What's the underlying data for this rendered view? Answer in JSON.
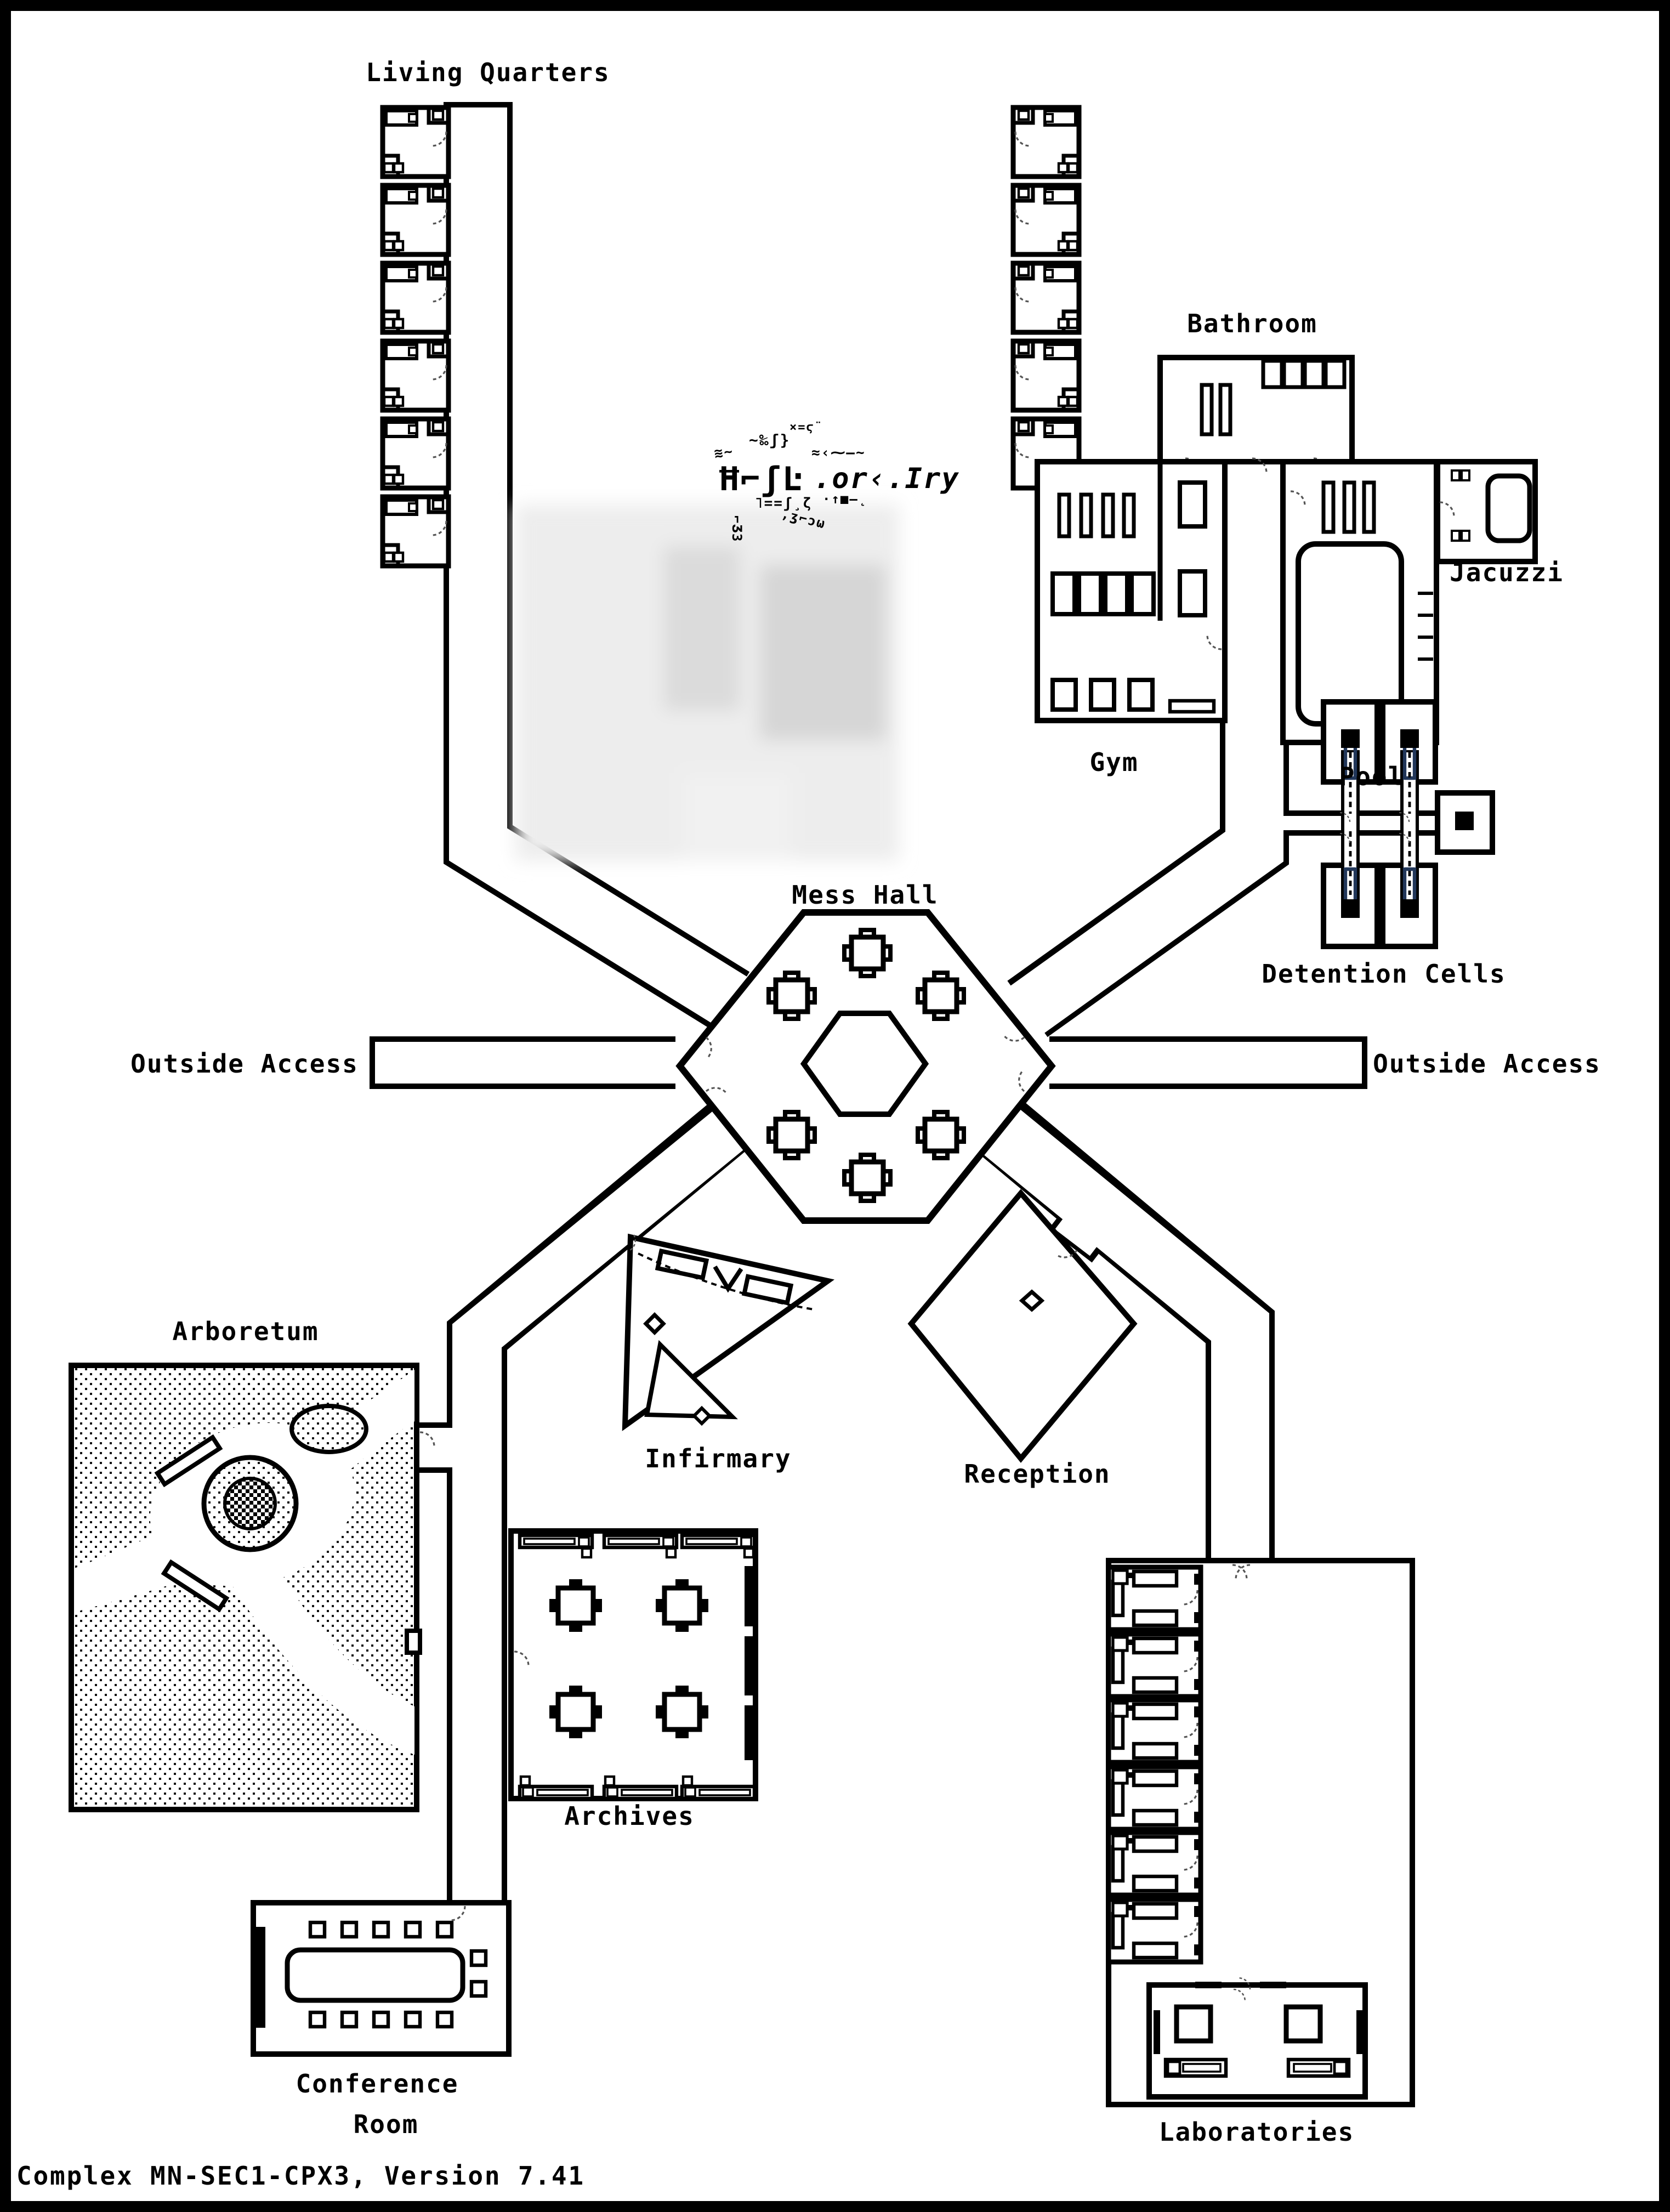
{
  "page": {
    "footer": "Complex MN-SEC1-CPX3, Version 7.41"
  },
  "labels": {
    "living_quarters": "Living Quarters",
    "bathroom": "Bathroom",
    "jacuzzi": "Jacuzzi",
    "gym": "Gym",
    "pool": "Pool",
    "detention_cells": "Detention Cells",
    "mess_hall": "Mess Hall",
    "outside_access_left": "Outside Access",
    "outside_access_right": "Outside Access",
    "arboretum": "Arboretum",
    "infirmary": "Infirmary",
    "reception": "Reception",
    "archives": "Archives",
    "conference_line1": "Conference",
    "conference_line2": "Room",
    "laboratories": "Laboratories"
  },
  "glitch": {
    "g1": "Ħ⌐ʃĿ",
    "g2": "≋~",
    "g3": "~‰ʃ}",
    "g4": "×=ϛ¨",
    "g5": ".or‹.Iry",
    "g6": "≈‹⁓—~",
    "g7": "⌐Ʒ3",
    "g8": "˥==ʃ¸ζ",
    "g9": ",ʒ⌐ɔω",
    "g10": "·↑■—˛"
  },
  "colors": {
    "wall": "#000000",
    "detention_bars": "#22375a",
    "background": "#ffffff",
    "redaction_field": "#ededed"
  }
}
